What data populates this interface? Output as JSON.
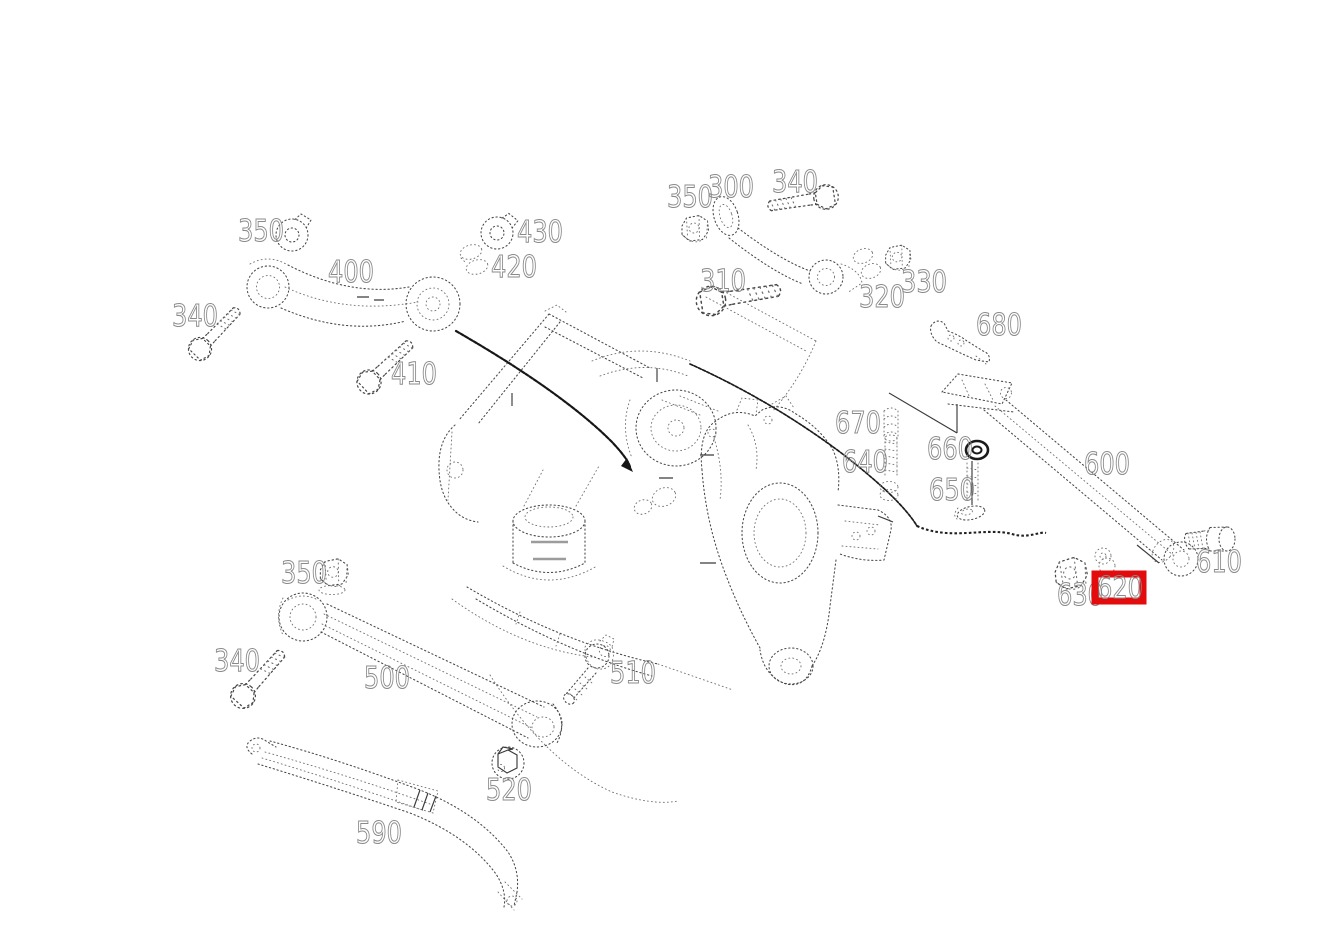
{
  "diagram": {
    "background": "#ffffff",
    "line_color": "#474747",
    "label_color": "#8a8a8a",
    "highlight_color": "#e30b0b",
    "highlighted_part": "620"
  },
  "labels": {
    "nut_350_upper_left": "350",
    "arm_400": "400",
    "nut_430": "430",
    "washers_420": "420",
    "bolt_340_upper_left": "340",
    "bolt_410": "410",
    "nut_350_top_center": "350",
    "arm_300": "300",
    "bolt_340_top_center": "340",
    "bolt_310": "310",
    "washers_320": "320",
    "nut_330": "330",
    "bracket_680": "680",
    "boot_670": "670",
    "bolt_640": "640",
    "washer_660": "660",
    "stud_650": "650",
    "arm_600": "600",
    "bolt_610": "610",
    "nut_630": "630",
    "bushing_620": "620",
    "nut_350_lower_left": "350",
    "bolt_340_lower_left": "340",
    "arm_500": "500",
    "bolt_510": "510",
    "bolt_520": "520",
    "link_590": "590"
  }
}
